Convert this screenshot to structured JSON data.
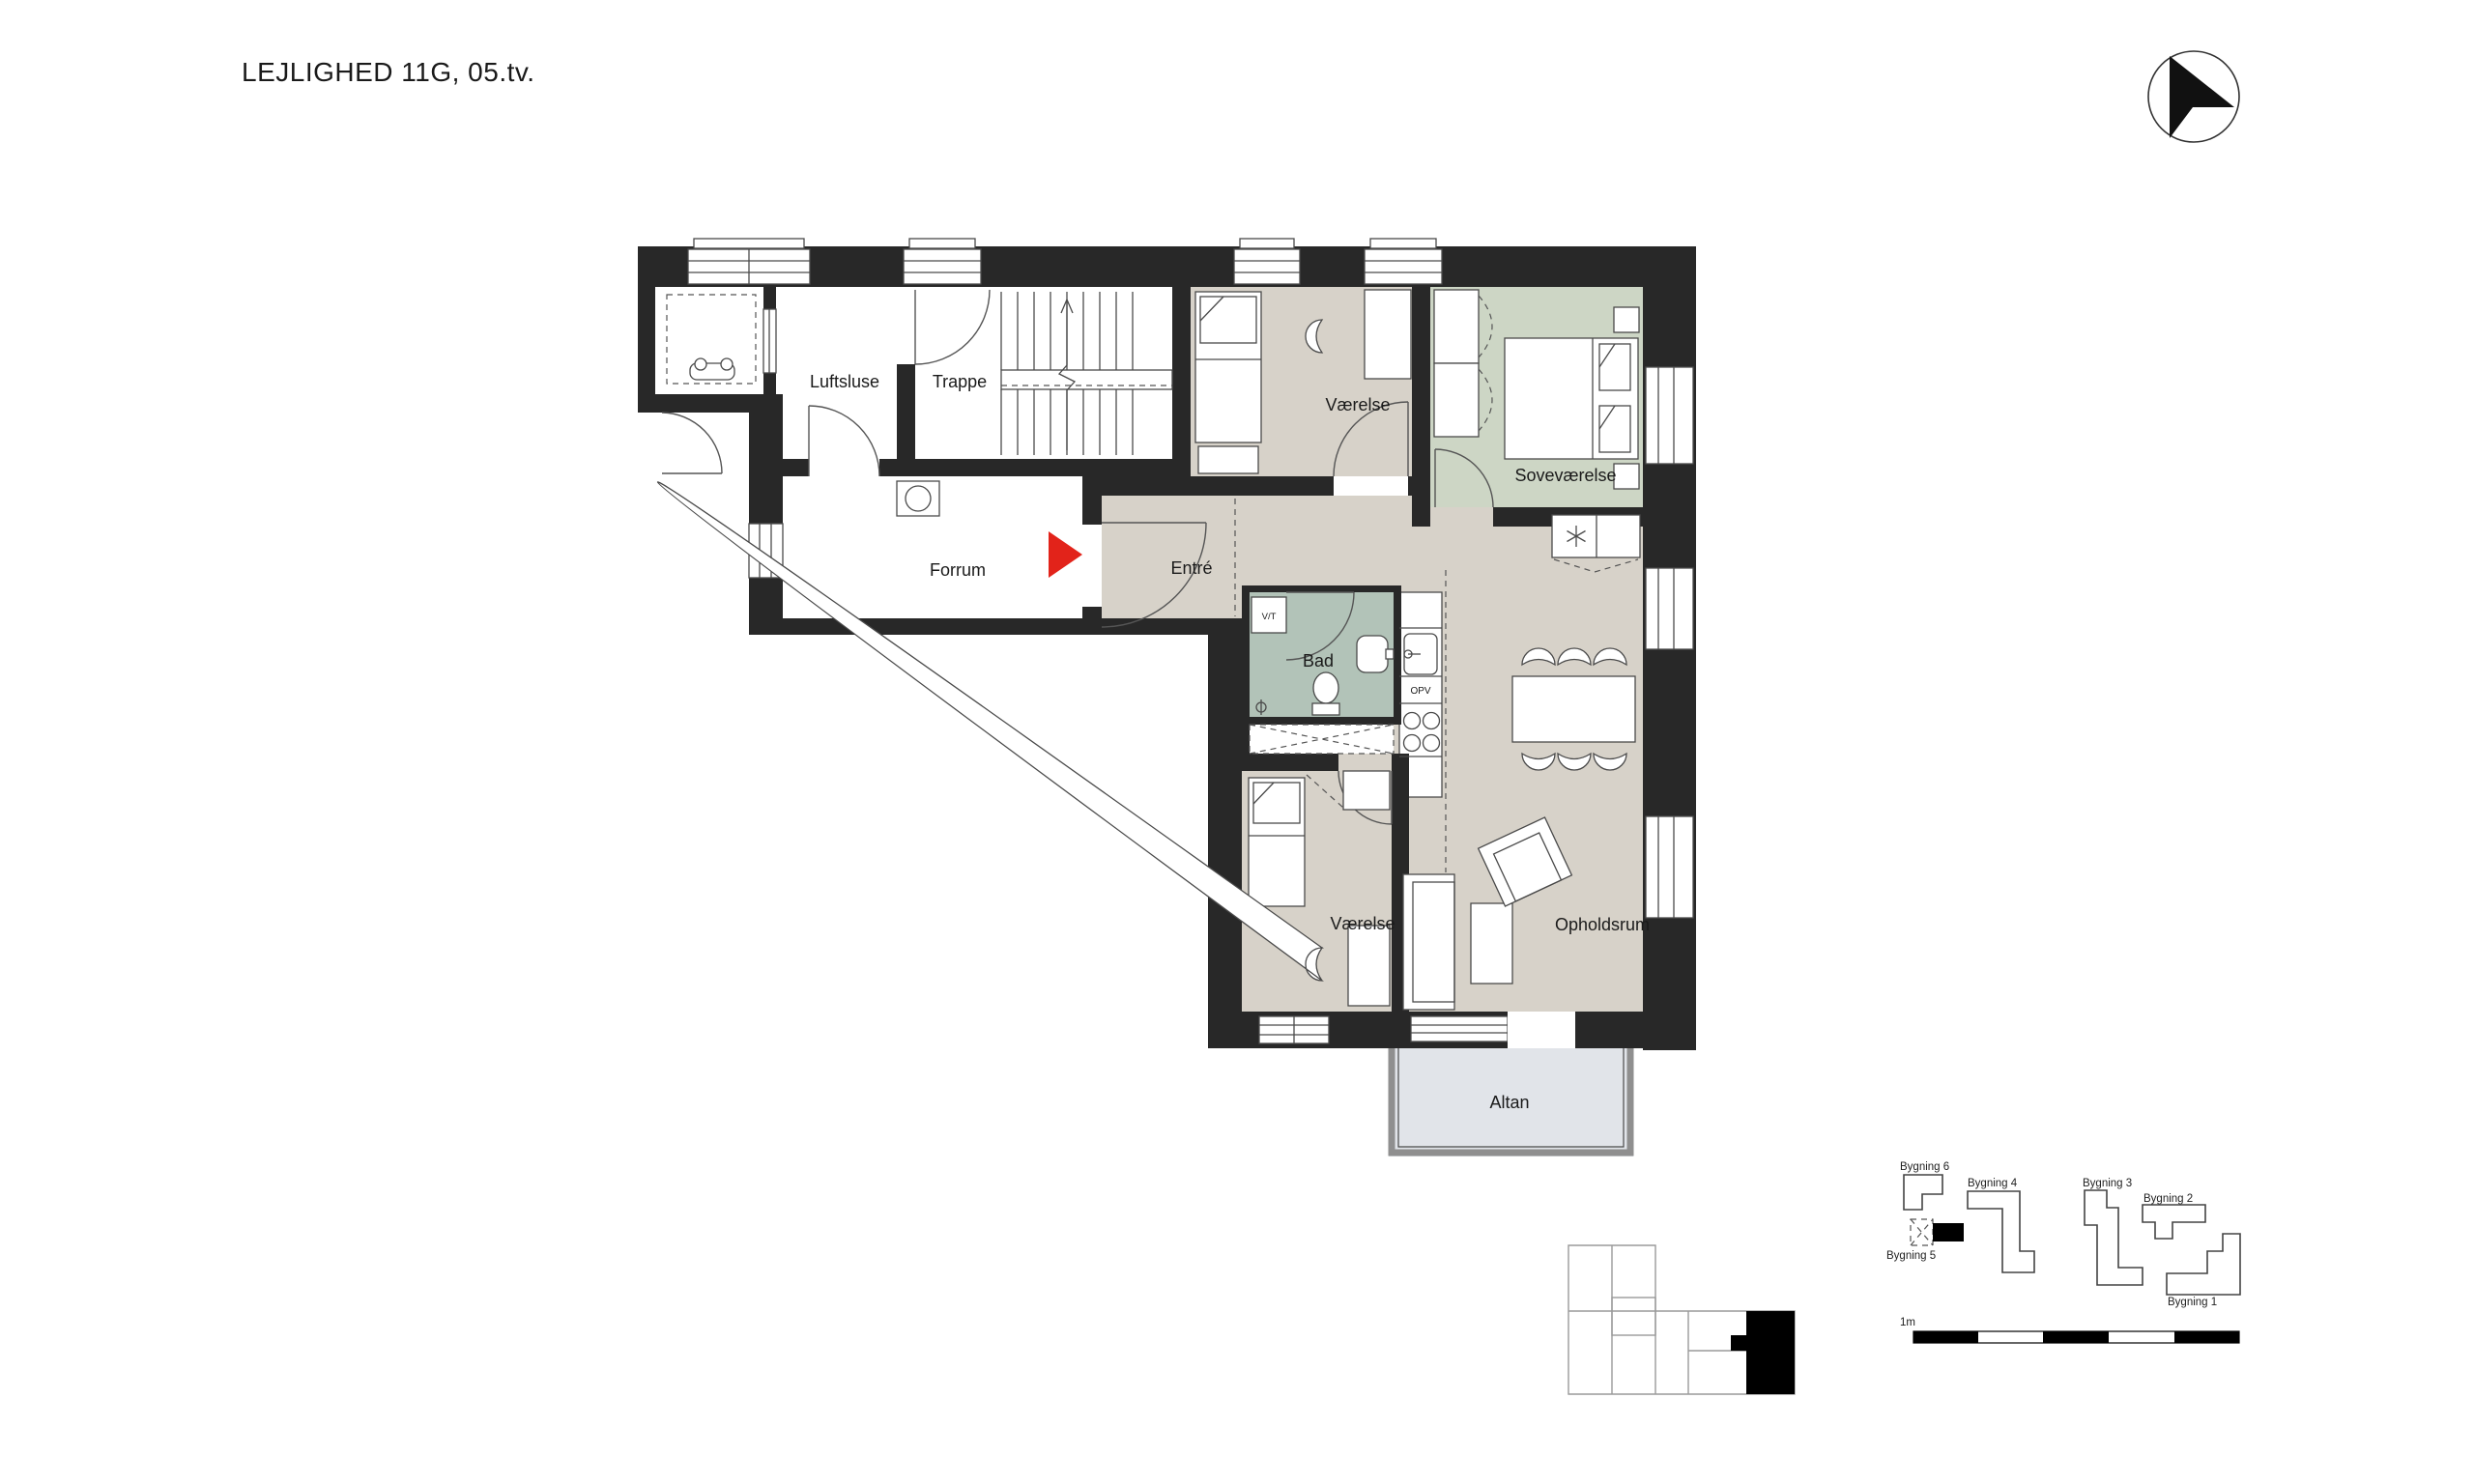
{
  "title": "LEJLIGHED  11G, 05.tv.",
  "plan": {
    "rooms": [
      {
        "id": "luftsluse",
        "label": "Luftsluse"
      },
      {
        "id": "trappe",
        "label": "Trappe"
      },
      {
        "id": "vaerelse-nord",
        "label": "Værelse"
      },
      {
        "id": "sovevaerelse",
        "label": "Soveværelse"
      },
      {
        "id": "forrum",
        "label": "Forrum"
      },
      {
        "id": "entre",
        "label": "Entré"
      },
      {
        "id": "bad",
        "label": "Bad"
      },
      {
        "id": "vaerelse-syd",
        "label": "Værelse"
      },
      {
        "id": "opholdsrum",
        "label": "Opholdsrum"
      },
      {
        "id": "altan",
        "label": "Altan"
      }
    ],
    "appliances": {
      "washer_dryer": "V/T",
      "dishwasher": "OPV"
    }
  },
  "key_plan": {
    "buildings": [
      {
        "label": "Bygning 6"
      },
      {
        "label": "Bygning 4"
      },
      {
        "label": "Bygning 3"
      },
      {
        "label": "Bygning 2"
      },
      {
        "label": "Bygning 5"
      },
      {
        "label": "Bygning 1"
      }
    ],
    "highlighted": "Bygning 5"
  },
  "scale_bar": {
    "label": "1m"
  },
  "colors": {
    "wall": "#282828",
    "floor_main": "#d7d2c9",
    "floor_bedroom_green": "#cdd6c5",
    "floor_bath": "#b2c3b8",
    "floor_balcony": "#e1e4e9",
    "entrance_arrow": "#e2231a"
  }
}
